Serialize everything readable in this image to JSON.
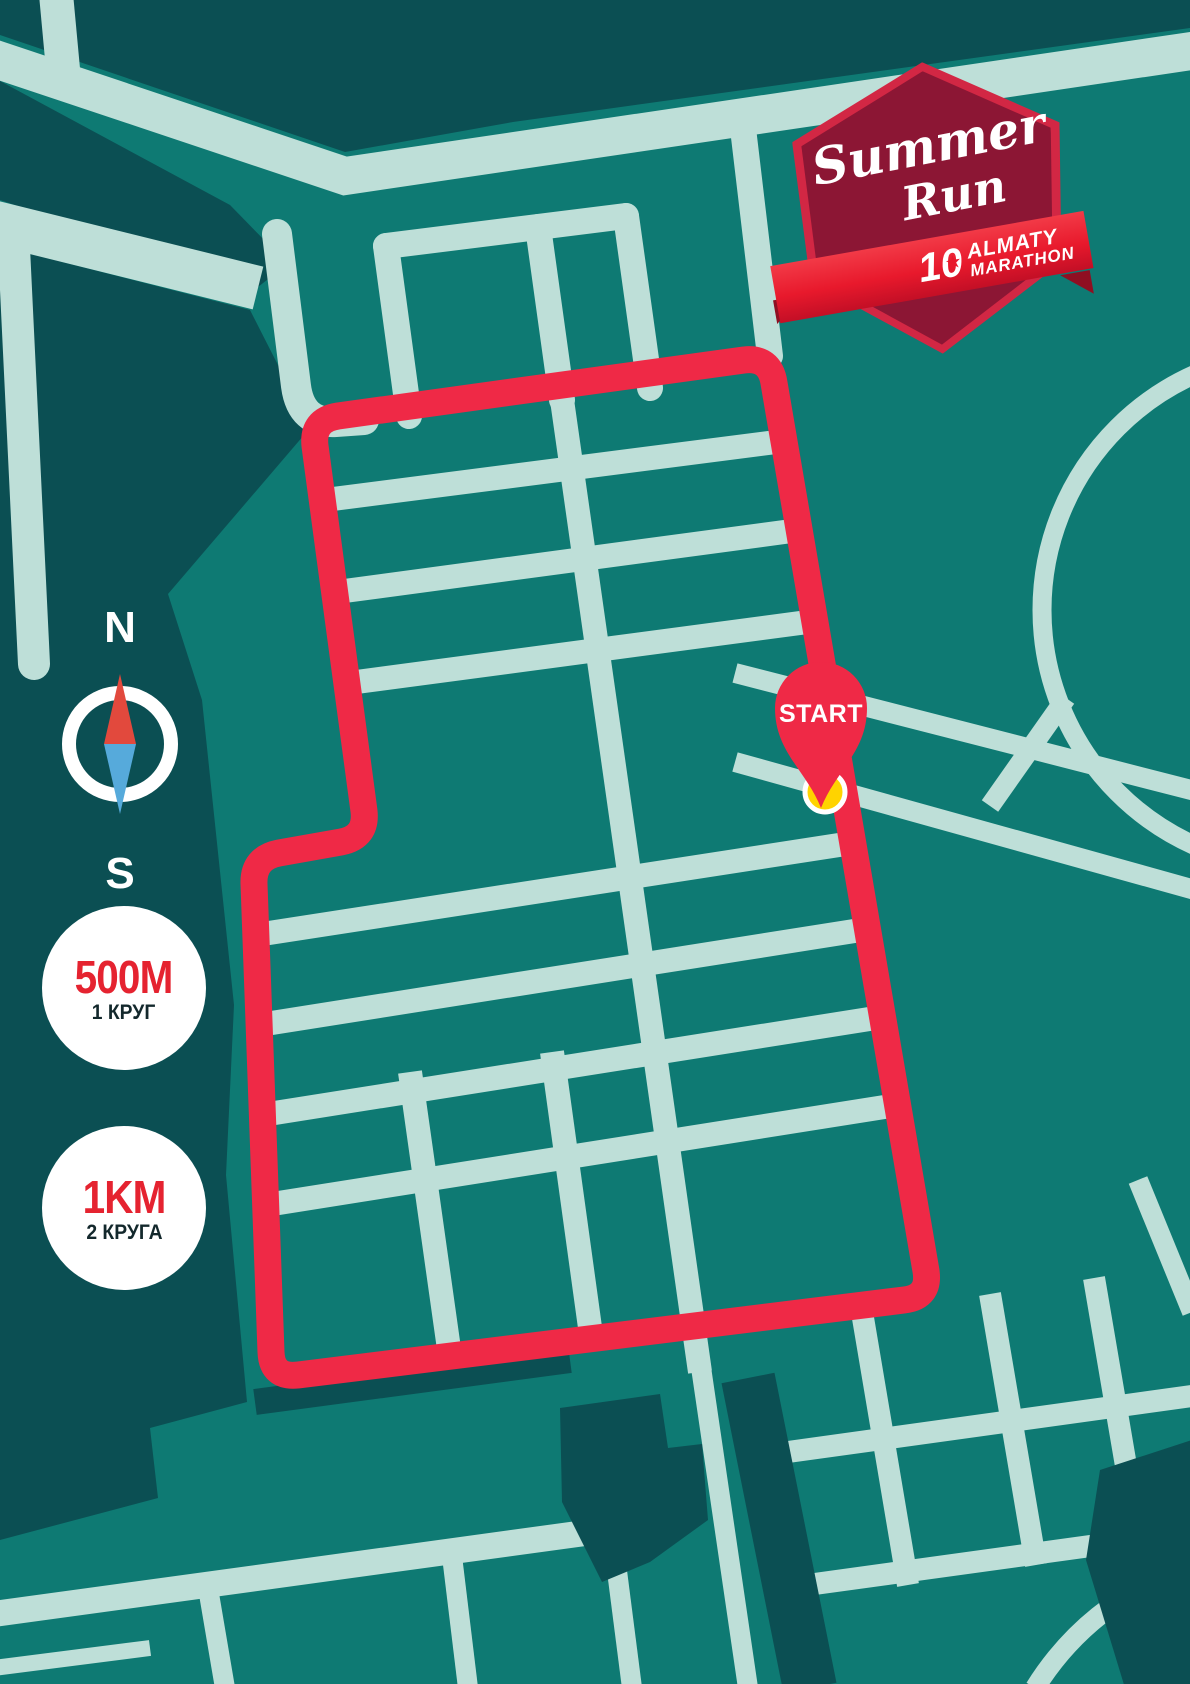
{
  "logo": {
    "title_line1": "Summer",
    "title_line2": "Run",
    "edition_number": "10",
    "org_line1": "ALMATY",
    "org_line2": "MARATHON"
  },
  "compass": {
    "north_label": "N",
    "south_label": "S"
  },
  "distance_badges": [
    {
      "distance": "500M",
      "laps": "1 КРУГ"
    },
    {
      "distance": "1KM",
      "laps": "2 КРУГА"
    }
  ],
  "start_marker": {
    "label": "START"
  },
  "icons": {
    "star": "★"
  },
  "palette": {
    "bg": "#0e7a73",
    "dark": "#0b4f53",
    "street": "#bedfd8",
    "route-red": "#ef2946",
    "crest-maroon": "#8c1634",
    "crest-border": "#d22744",
    "ribbon-red": "#e8192c",
    "ribbon-fold": "#8f0f22",
    "badge-text-red": "#e52330",
    "label-dark": "#13282c",
    "start-yellow": "#ffd300",
    "compass-red": "#e2493d",
    "compass-blue": "#56aadb",
    "white": "#ffffff"
  }
}
